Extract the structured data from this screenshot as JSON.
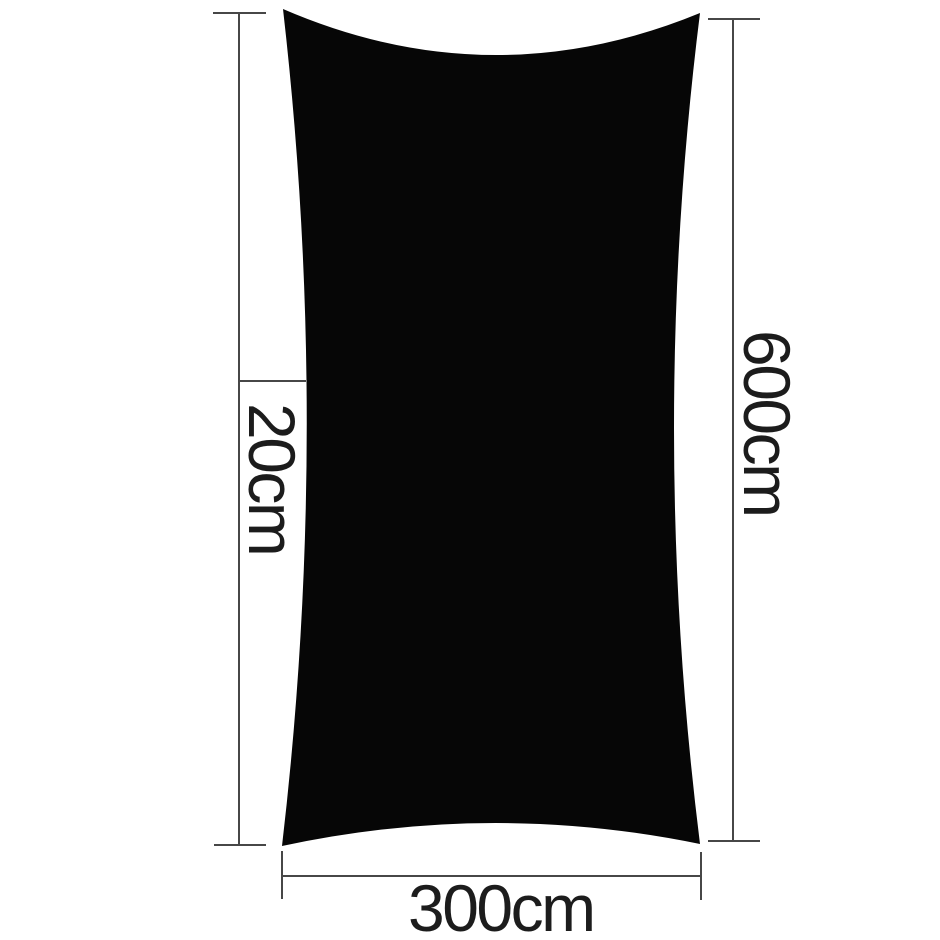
{
  "diagram": {
    "kind": "shade-sail-dimension-diagram",
    "colors": {
      "shape_fill": "#060606",
      "line_color": "#474747",
      "text_color": "#1c1c1c",
      "background": "#ffffff"
    },
    "measurements": {
      "curve_depth": {
        "side": "left",
        "label": "20cm"
      },
      "height": {
        "side": "right",
        "label": "600cm"
      },
      "width": {
        "side": "bottom",
        "label": "300cm"
      }
    }
  }
}
